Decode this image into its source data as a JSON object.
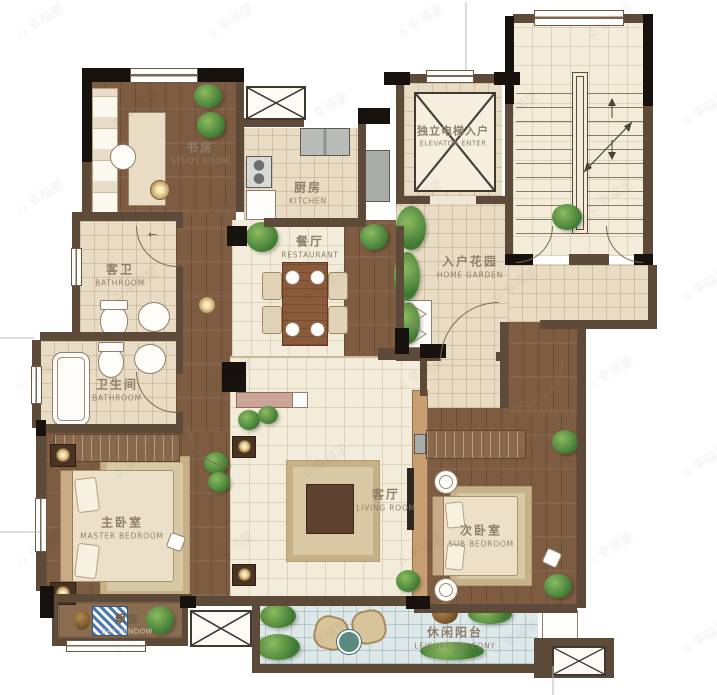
{
  "watermark": {
    "icon": "⌂",
    "text": "幸福里"
  },
  "icons": {
    "door_arrow": "←"
  },
  "colors": {
    "wall": "#5e4a39",
    "black_column": "#17120d",
    "wood_floor": "#7e5c42",
    "tile_floor": "#e9dcc4",
    "living_floor": "#f3ecda",
    "balcony_floor": "#dfe8e8",
    "label_text": "#8d7f6b",
    "plant_green": "#4c8038"
  },
  "rooms": {
    "study": {
      "zh": "书房",
      "en": "STUDY ROOM"
    },
    "kitchen": {
      "zh": "厨房",
      "en": "KITCHEN"
    },
    "elevator": {
      "zh": "独立电梯入户",
      "en": "ELEVATOR ENTER"
    },
    "guest_bathroom": {
      "zh": "客卫",
      "en": "BATHROOM"
    },
    "restaurant": {
      "zh": "餐厅",
      "en": "RESTAURANT"
    },
    "home_garden": {
      "zh": "入户花园",
      "en": "HOME GARDEN"
    },
    "bathroom": {
      "zh": "卫生间",
      "en": "BATHROOM"
    },
    "master_bedroom": {
      "zh": "主卧室",
      "en": "MASTER BEDROOM"
    },
    "living_room": {
      "zh": "客厅",
      "en": "LIVING ROOM"
    },
    "sub_bedroom": {
      "zh": "次卧室",
      "en": "SUB BEDROOM"
    },
    "bay_window": {
      "zh": "飘窗",
      "en": "BAY WINDOW"
    },
    "leisure_balcony": {
      "zh": "休闲阳台",
      "en": "LEISURE BALCONY"
    }
  }
}
